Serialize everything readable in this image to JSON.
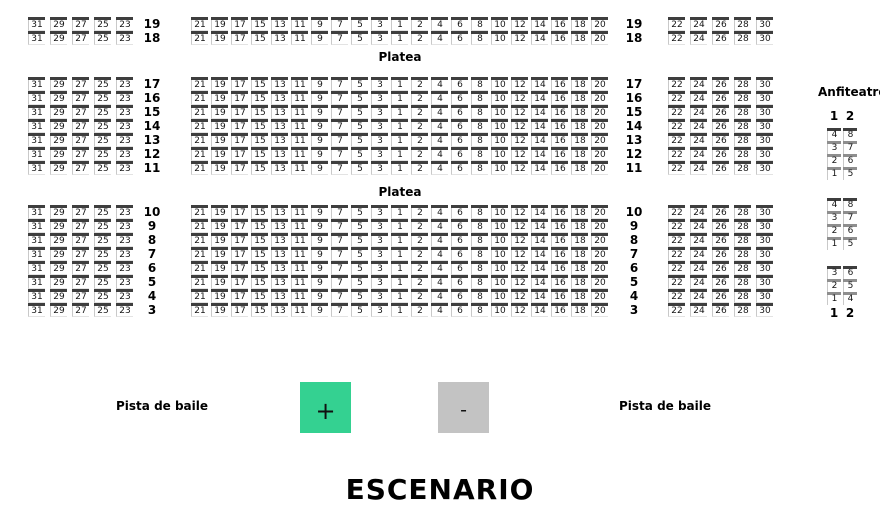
{
  "seatmap": {
    "platea_label": "Platea",
    "row_groups": [
      {
        "rows": [
          "19",
          "18"
        ]
      },
      {
        "rows": [
          "17",
          "16",
          "15",
          "14",
          "13",
          "12",
          "11"
        ]
      },
      {
        "rows": [
          "10",
          "9",
          "8",
          "7",
          "6",
          "5",
          "4",
          "3"
        ]
      }
    ],
    "left_seats": [
      "31",
      "29",
      "27",
      "25",
      "23"
    ],
    "center_seats": [
      "21",
      "19",
      "17",
      "15",
      "13",
      "11",
      "9",
      "7",
      "5",
      "3",
      "1",
      "2",
      "4",
      "6",
      "8",
      "10",
      "12",
      "14",
      "16",
      "18",
      "20"
    ],
    "right_seats": [
      "22",
      "24",
      "26",
      "28",
      "30"
    ]
  },
  "anfiteatro": {
    "title": "Anfiteatro",
    "column_header": [
      "1",
      "2"
    ],
    "column_footer": [
      "1",
      "2"
    ],
    "groups": [
      {
        "rows": [
          [
            "4",
            "8"
          ],
          [
            "3",
            "7"
          ],
          [
            "2",
            "6"
          ],
          [
            "1",
            "5"
          ]
        ]
      },
      {
        "rows": [
          [
            "4",
            "8"
          ],
          [
            "3",
            "7"
          ],
          [
            "2",
            "6"
          ],
          [
            "1",
            "5"
          ]
        ]
      },
      {
        "rows": [
          [
            "3",
            "6"
          ],
          [
            "2",
            "5"
          ],
          [
            "1",
            "4"
          ]
        ]
      }
    ]
  },
  "zoom_controls": {
    "zoom_in_label": "+",
    "zoom_out_label": "-"
  },
  "floor_labels": {
    "pista_left": "Pista de baile",
    "pista_right": "Pista de baile"
  },
  "stage_label": "ESCENARIO",
  "colors": {
    "seat_bar": "#3e3e3e",
    "anfi_inner_bar": "#8e8e8e",
    "zoom_in_bg": "#34d191",
    "zoom_out_bg": "#c3c3c3",
    "background": "#ffffff"
  }
}
